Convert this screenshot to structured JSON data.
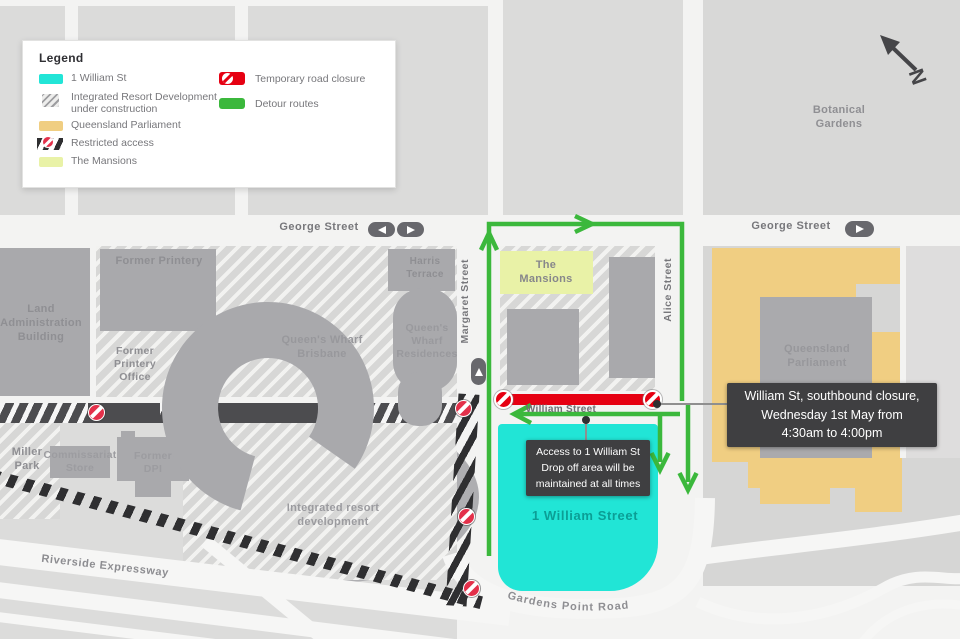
{
  "legend": {
    "title": "Legend",
    "items": [
      {
        "label": "1 William St"
      },
      {
        "label": "Integrated Resort Development",
        "label2": "under construction"
      },
      {
        "label": "Queensland Parliament"
      },
      {
        "label": "Restricted access"
      },
      {
        "label": "The Mansions"
      },
      {
        "label": "Temporary road closure"
      },
      {
        "label": "Detour routes"
      }
    ]
  },
  "compass": {
    "north": "N"
  },
  "streets": {
    "george_left": "George Street",
    "george_right": "George Street",
    "margaret": "Margaret Street",
    "alice": "Alice Street",
    "william": "William Street",
    "gardens_point": "Gardens Point Road",
    "riverside": "Riverside Expressway"
  },
  "places": {
    "botanical": [
      "Botanical",
      "Gardens"
    ],
    "land_admin": [
      "Land",
      "Administration",
      "Building"
    ],
    "former_printery": "Former Printery",
    "harris": [
      "Harris",
      "Terrace"
    ],
    "printery_office": [
      "Former",
      "Printery",
      "Office"
    ],
    "qw_brisbane": [
      "Queen's Wharf",
      "Brisbane"
    ],
    "qw_residences": [
      "Queen's",
      "Wharf",
      "Residences"
    ],
    "mansions": [
      "The",
      "Mansions"
    ],
    "parliament": [
      "Queensland",
      "Parliament"
    ],
    "miller": [
      "Miller",
      "Park"
    ],
    "commissariat": [
      "Commissariat",
      "Store"
    ],
    "former_dpi": [
      "Former",
      "DPI"
    ],
    "resort": [
      "Integrated resort",
      "development"
    ],
    "one_william": "1 William Street"
  },
  "callouts": {
    "closure": [
      "William St, southbound closure,",
      "Wednesday 1st May from",
      "4:30am to 4:00pm"
    ],
    "access": [
      "Access to 1 William St",
      "Drop off area will be",
      "maintained at all times"
    ]
  },
  "colors": {
    "one_william_cyan": "#22e5d7",
    "parliament_tan": "#f0ce82",
    "mansions_green": "#e9f2a7",
    "closure_red": "#e60012",
    "detour_green": "#3bb83c",
    "callout_bg": "#3f3f41"
  }
}
